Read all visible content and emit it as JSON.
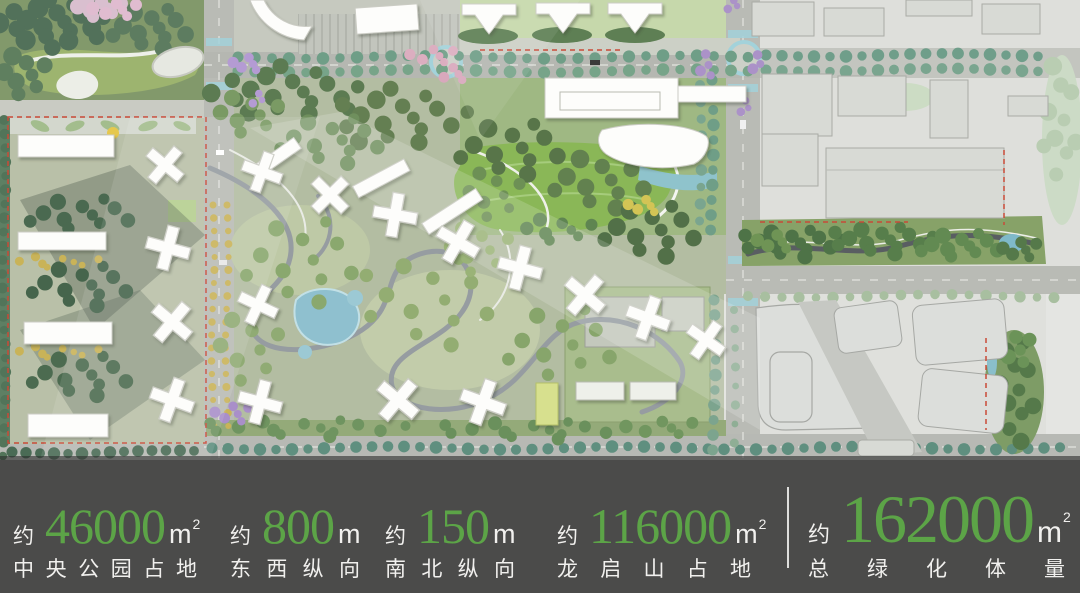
{
  "theme": {
    "bar_bg": "#4b4b4a",
    "accent_green": "#5ca447",
    "text_white": "#f1f0ee",
    "divider_white": "#eeeeec"
  },
  "map": {
    "kind": "masterplan-site-rendering",
    "palette": {
      "park_dark_green": "#52715a",
      "lawn_bright_green": "#8ab757",
      "residential_green": "#b3bda2",
      "context_gray": "#dedfdb",
      "road_gray": "#b9bbb5",
      "water_blue": "#8fc0cf",
      "boundary_red": "#c94a38",
      "tree_teal": "#6f9e87",
      "tree_yellow": "#c9b358",
      "tree_purple": "#ab92c8",
      "tree_pink": "#dcaec0"
    }
  },
  "stats_bar": {
    "stats": [
      {
        "prefix": "约",
        "value": "46000",
        "unit": "m",
        "unit_sup": "2",
        "label": "中央公园占地"
      },
      {
        "prefix": "约",
        "value": "800",
        "unit": "m",
        "unit_sup": "",
        "label": "东西纵向"
      },
      {
        "prefix": "约",
        "value": "150",
        "unit": "m",
        "unit_sup": "",
        "label": "南北纵向"
      },
      {
        "prefix": "约",
        "value": "116000",
        "unit": "m",
        "unit_sup": "2",
        "label": "龙启山占地"
      },
      {
        "prefix": "约",
        "value": "162000",
        "unit": "m",
        "unit_sup": "2",
        "label": "总绿化体量"
      }
    ]
  }
}
